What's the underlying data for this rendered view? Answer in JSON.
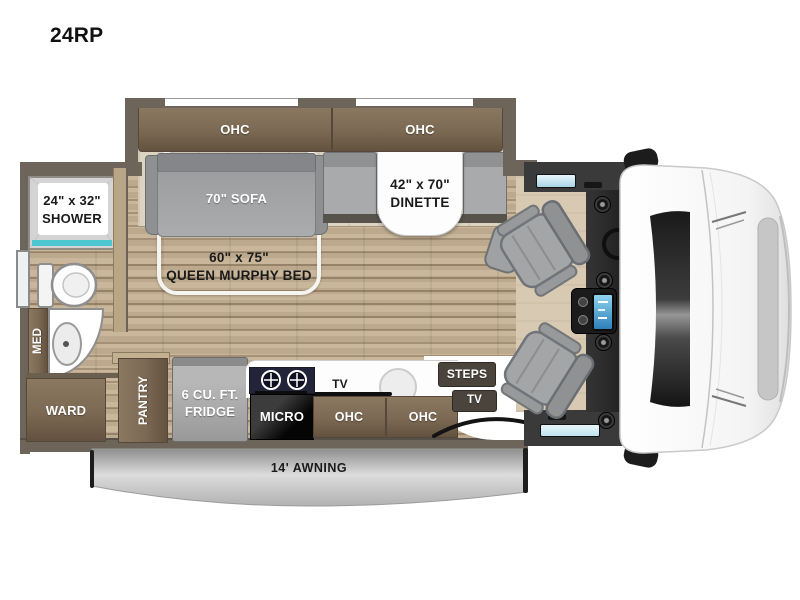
{
  "title": "24RP",
  "palette": {
    "wall": "#6e655a",
    "cabinet_dark": "#63523f",
    "cabinet_light": "#8a7861",
    "floor_wood": "#c6b295",
    "slide_floor": "#ddd3c1",
    "seat_gray": "#a3a5a7",
    "shower_teal": "#4cc6d0",
    "cab_window_blue": "#bfe3f0",
    "counter_white": "#ffffff",
    "awning_gray": "#c2c2c2",
    "stove_panel": "#23233a"
  },
  "slide": {
    "ohc_left": "OHC",
    "ohc_right": "OHC",
    "sofa": "70\" SOFA",
    "dinette_line1": "42\" x 70\"",
    "dinette_line2": "DINETTE"
  },
  "bed": {
    "line1": "60\" x 75\"",
    "line2": "QUEEN MURPHY BED"
  },
  "bath": {
    "shower_line1": "24\" x 32\"",
    "shower_line2": "SHOWER",
    "med": "MED",
    "ward": "WARD"
  },
  "kitchen": {
    "pantry": "PANTRY",
    "fridge_line1": "6 CU. FT.",
    "fridge_line2": "FRIDGE",
    "micro": "MICRO",
    "counter_tv": "TV",
    "ohc_left": "OHC",
    "ohc_right": "OHC"
  },
  "entry": {
    "steps": "STEPS",
    "tv": "TV"
  },
  "exterior": {
    "awning": "14' AWNING"
  }
}
